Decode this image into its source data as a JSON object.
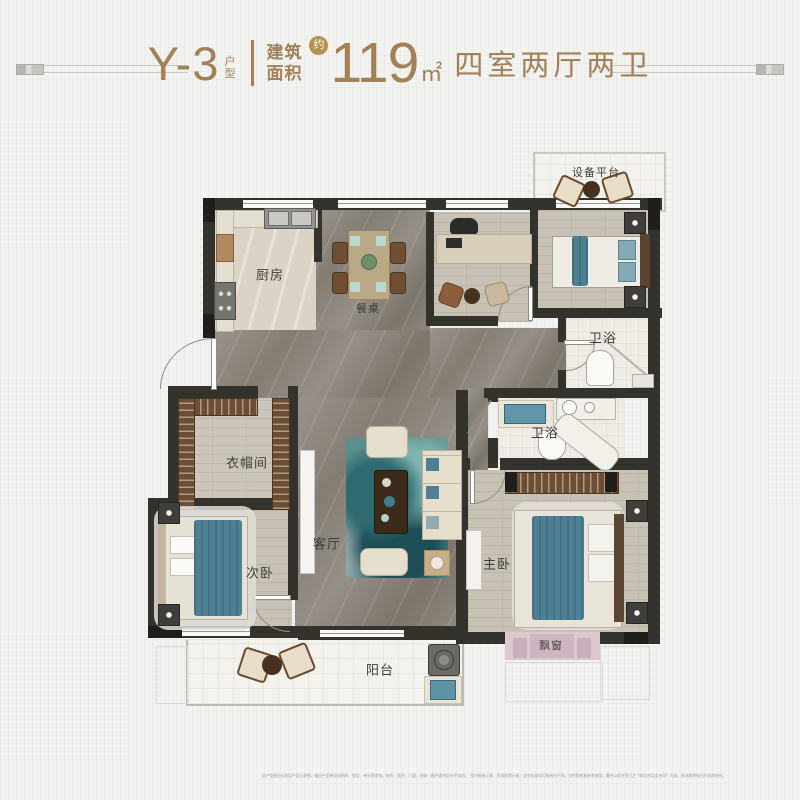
{
  "header": {
    "unit_code": "Y-3",
    "unit_type_label": "户型",
    "area_prefix": "建筑面积",
    "approx_badge": "约",
    "area_value": "119",
    "area_unit": "㎡",
    "layout_summary": "四室两厅两卫"
  },
  "plan": {
    "labels": {
      "equipment_platform": "设备平台",
      "kitchen": "厨房",
      "dining_table": "餐桌",
      "bathroom_upper": "卫浴",
      "bathroom_lower": "卫浴",
      "cloakroom": "衣帽间",
      "secondary_bedroom": "次卧",
      "living_room": "客厅",
      "master_bedroom": "主卧",
      "bay_window": "飘窗",
      "balcony": "阳台"
    }
  },
  "footer": {
    "disclaimer": "此户型图为标准层户型示意图，相应户型单位因朝向、楼层、单元等差别，结构、面积、门窗、墙体（图中虚线部分不包括）、室内装修示意、家具配置示意、交房标准均可能有所不同，仅供购房者参考使用，最终以双方签订之《商品房买卖合同》为准，具体解释权归开发商所有。"
  },
  "colors": {
    "accent_bronze": "#a28058",
    "badge_gold": "#b3914e",
    "wall_dark": "#34322c",
    "teal_accent": "#4d8093",
    "marble_gray": "#8b857d",
    "wood_light": "#c7c1b6"
  }
}
